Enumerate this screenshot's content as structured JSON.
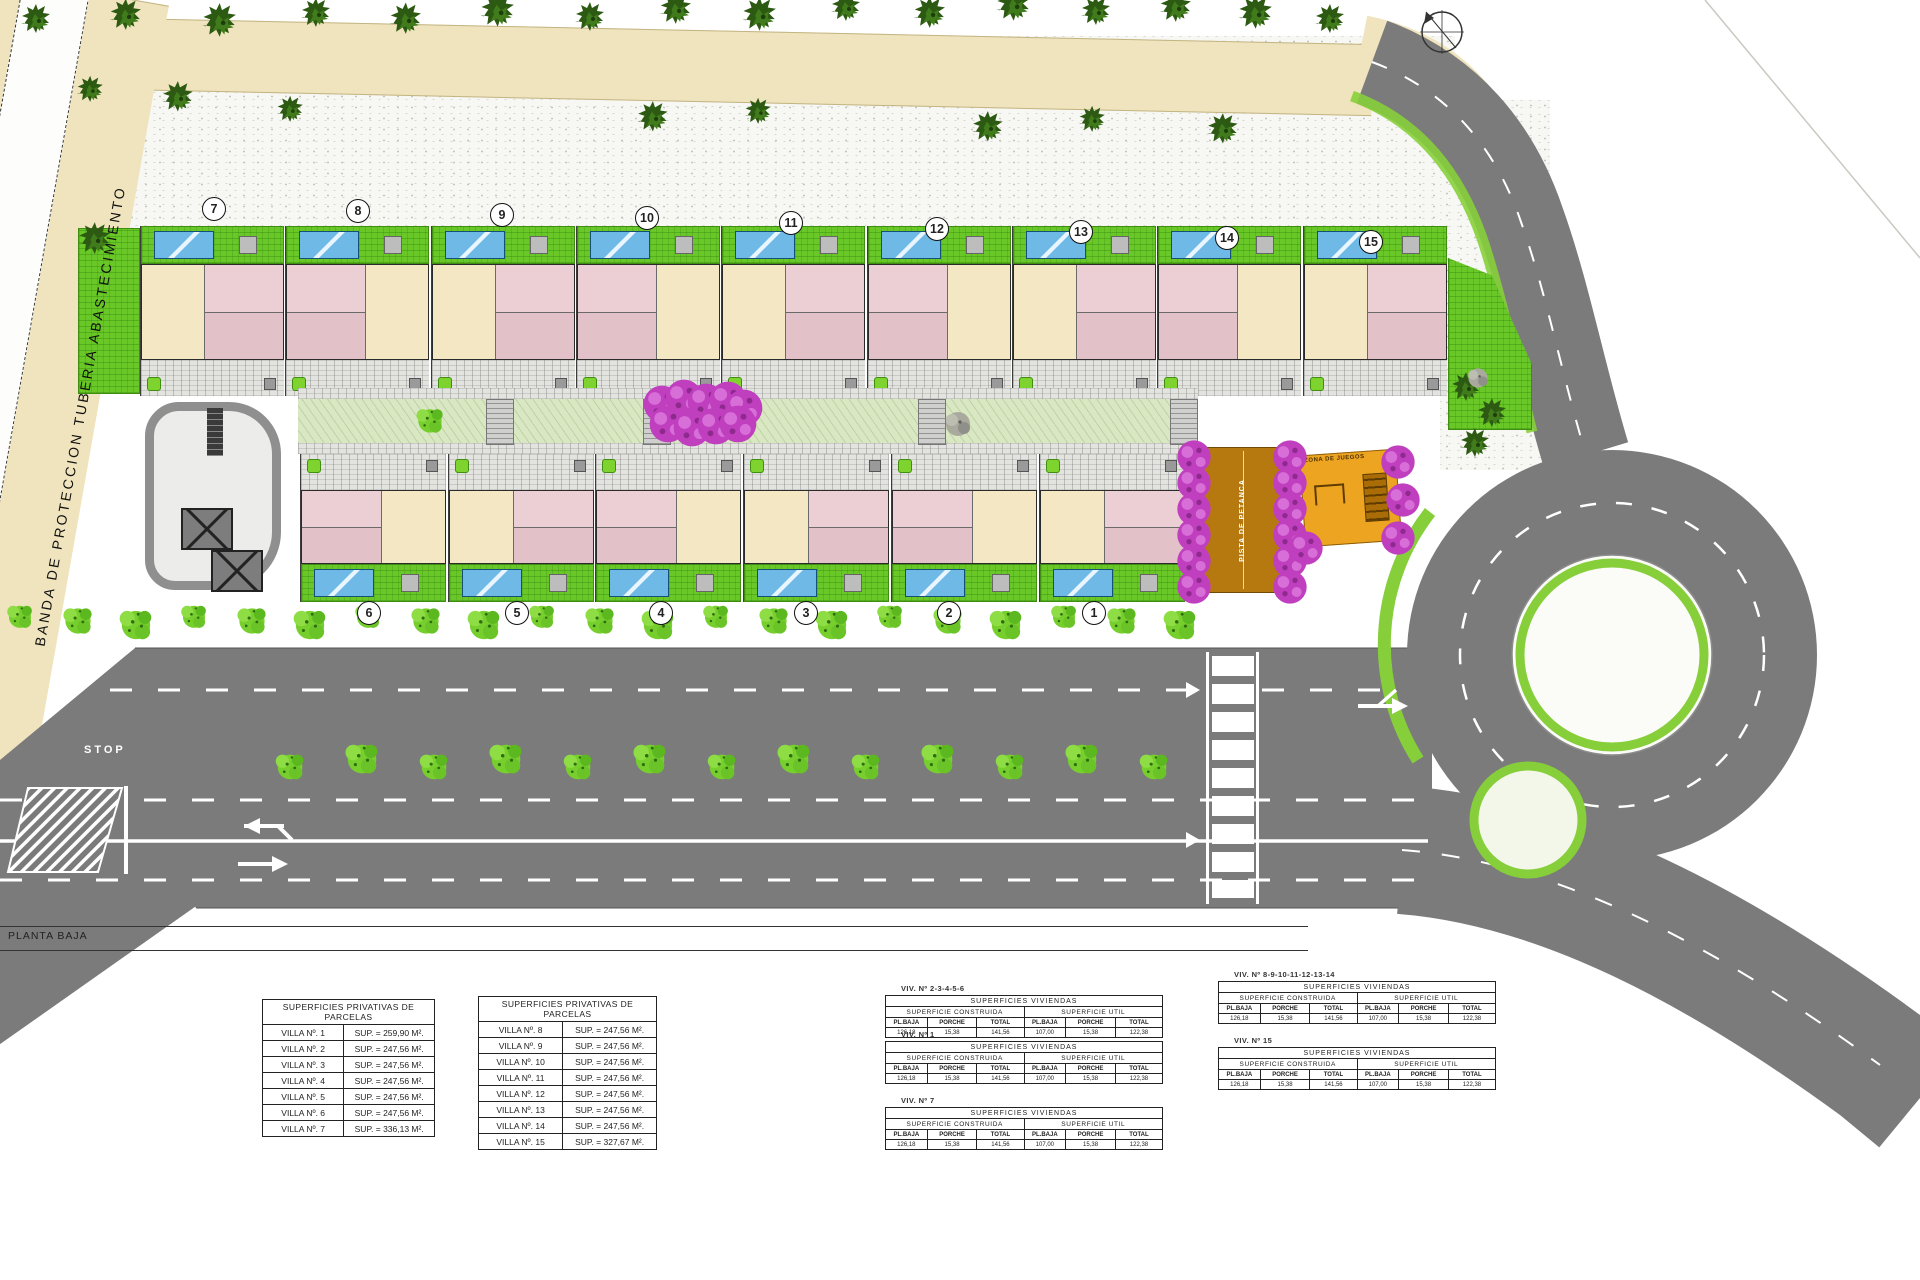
{
  "labels": {
    "left_band": "BANDA DE PROTECCION TUBERIA ABASTECIMIENTO",
    "planta_baja": "PLANTA BAJA",
    "stop": "STOP",
    "petanca": "PISTA DE PETANCA",
    "juegos": "ZONA DE JUEGOS"
  },
  "villas": {
    "top_numbers": [
      "7",
      "8",
      "9",
      "10",
      "11",
      "12",
      "13",
      "14",
      "15"
    ],
    "bottom_numbers": [
      "6",
      "5",
      "4",
      "3",
      "2",
      "1"
    ]
  },
  "parcel_tables": [
    {
      "title": "SUPERFICIES PRIVATIVAS DE PARCELAS",
      "rows": [
        [
          "VILLA Nº. 1",
          "SUP. = 259,90 M²."
        ],
        [
          "VILLA Nº. 2",
          "SUP. = 247,56 M²."
        ],
        [
          "VILLA Nº. 3",
          "SUP. = 247,56 M²."
        ],
        [
          "VILLA Nº. 4",
          "SUP. = 247,56 M²."
        ],
        [
          "VILLA Nº. 5",
          "SUP. = 247,56 M²."
        ],
        [
          "VILLA Nº. 6",
          "SUP. = 247,56 M²."
        ],
        [
          "VILLA Nº. 7",
          "SUP. = 336,13 M²."
        ]
      ]
    },
    {
      "title": "SUPERFICIES PRIVATIVAS DE PARCELAS",
      "rows": [
        [
          "VILLA Nº. 8",
          "SUP. = 247,56 M²."
        ],
        [
          "VILLA Nº. 9",
          "SUP. = 247,56 M²."
        ],
        [
          "VILLA Nº. 10",
          "SUP. = 247,56 M²."
        ],
        [
          "VILLA Nº. 11",
          "SUP. = 247,56 M²."
        ],
        [
          "VILLA Nº. 12",
          "SUP. = 247,56 M²."
        ],
        [
          "VILLA Nº. 13",
          "SUP. = 247,56 M²."
        ],
        [
          "VILLA Nº. 14",
          "SUP. = 247,56 M²."
        ],
        [
          "VILLA Nº. 15",
          "SUP. = 327,67 M²."
        ]
      ]
    }
  ],
  "viviendas_tables": {
    "header": "SUPERFICIES VIVIENDAS",
    "group_construida": "SUPERFICIE CONSTRUIDA",
    "group_util": "SUPERFICIE UTIL",
    "columns": [
      "PL.BAJA",
      "PORCHE",
      "TOTAL",
      "PL.BAJA",
      "PORCHE",
      "TOTAL"
    ],
    "values": [
      "126,18",
      "15,38",
      "141,56",
      "107,00",
      "15,38",
      "122,38"
    ],
    "groups": [
      {
        "title": "VIV. Nº 2-3-4-5-6"
      },
      {
        "title": "VIV. Nº 1"
      },
      {
        "title": "VIV. Nº 7"
      },
      {
        "title": "VIV. Nº 8-9-10-11-12-13-14"
      },
      {
        "title": "VIV. Nº 15"
      }
    ]
  }
}
